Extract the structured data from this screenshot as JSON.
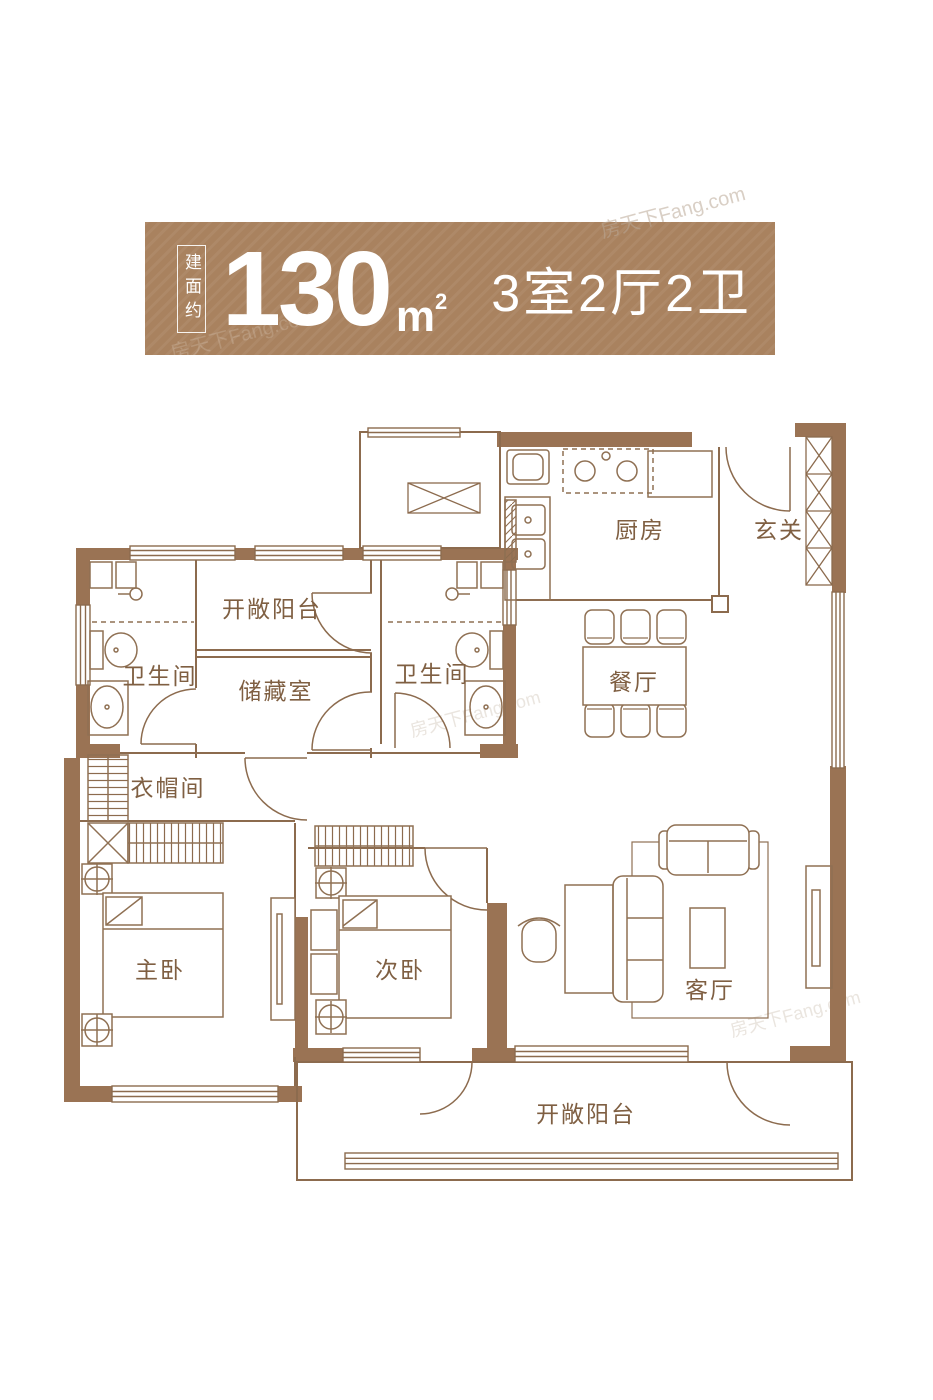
{
  "banner": {
    "build_area_prefix": "建面约",
    "area_value": "130",
    "area_unit": "m",
    "area_unit_sup": "2",
    "layout_summary": "3室2厅2卫",
    "bg_color": "#a9825f",
    "text_color": "#ffffff"
  },
  "watermark": {
    "text": "房天下Fang.com"
  },
  "floor_plan": {
    "wall_color": "#9a7354",
    "line_color": "#8c6b4e",
    "label_color": "#7f5f42",
    "rooms": {
      "kitchen": {
        "label": "厨房"
      },
      "entry": {
        "label": "玄关"
      },
      "balcony_top": {
        "label": "开敞阳台"
      },
      "bath_left": {
        "label": "卫生间"
      },
      "storage": {
        "label": "储藏室"
      },
      "bath_right": {
        "label": "卫生间"
      },
      "dining": {
        "label": "餐厅"
      },
      "cloakroom": {
        "label": "衣帽间"
      },
      "master_bedroom": {
        "label": "主卧"
      },
      "second_bedroom": {
        "label": "次卧"
      },
      "living": {
        "label": "客厅"
      },
      "balcony_bottom": {
        "label": "开敞阳台"
      }
    }
  }
}
